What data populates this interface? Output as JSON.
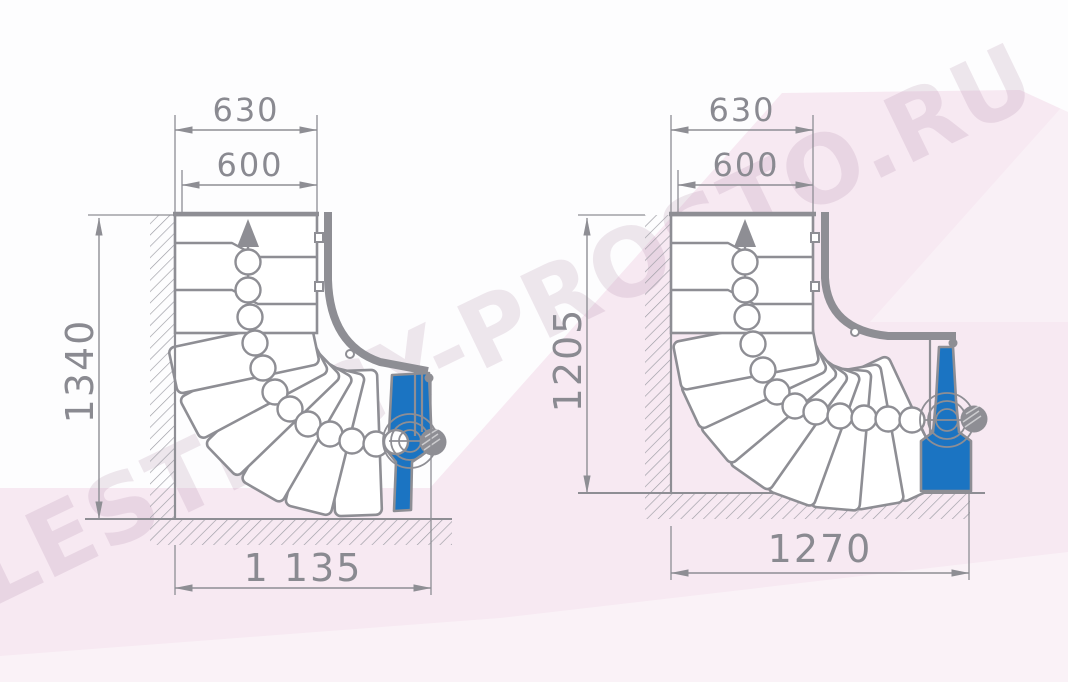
{
  "watermark": {
    "text": "LESTNICY-PROSTO.RU"
  },
  "colors": {
    "line_gray": "#8e8e94",
    "accent_blue": "#1b74c2",
    "background_pink": "#f7e9f2",
    "paper_white": "#fdfdfe"
  },
  "left_drawing": {
    "dim_top_outer": "630",
    "dim_top_inner": "600",
    "dim_side_height": "1340",
    "dim_bottom_width": "1 135"
  },
  "right_drawing": {
    "dim_top_outer": "630",
    "dim_top_inner": "600",
    "dim_side_height": "1205",
    "dim_bottom_width": "1270"
  }
}
